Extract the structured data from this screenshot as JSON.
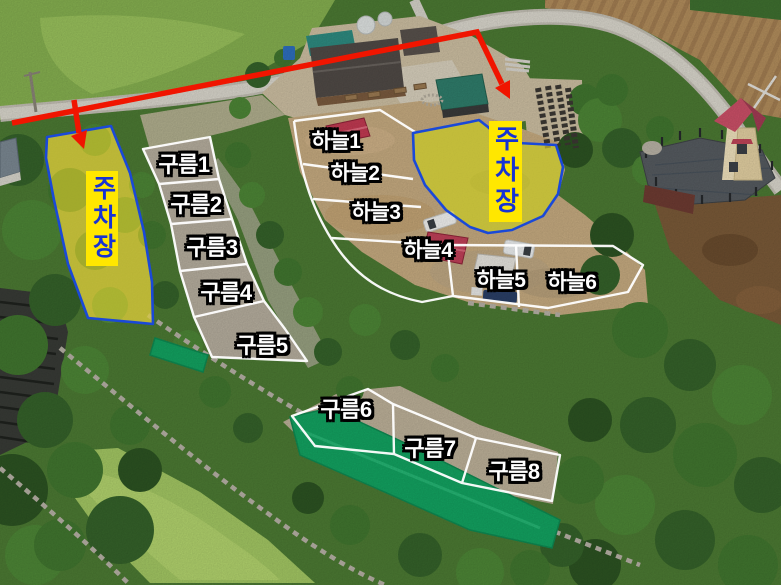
{
  "parking_left": {
    "label": "주차장"
  },
  "parking_right": {
    "label": "주차장"
  },
  "sites": {
    "sky": [
      {
        "label": "하늘1"
      },
      {
        "label": "하늘2"
      },
      {
        "label": "하늘3"
      },
      {
        "label": "하늘4"
      },
      {
        "label": "하늘5"
      },
      {
        "label": "하늘6"
      }
    ],
    "cloud": [
      {
        "label": "구름1"
      },
      {
        "label": "구름2"
      },
      {
        "label": "구름3"
      },
      {
        "label": "구름4"
      },
      {
        "label": "구름5"
      },
      {
        "label": "구름6"
      },
      {
        "label": "구름7"
      },
      {
        "label": "구름8"
      }
    ]
  },
  "colors": {
    "arrow": "#f01500",
    "parking_fill": "#e8d52e",
    "parking_border": "#1a49d8",
    "parking_text": "#1733d4",
    "parking_text_bg": "#ffe700",
    "site_text": "#ffffff",
    "site_text_outline": "#000000",
    "site_line": "#ffffff",
    "tarp": "#13a361"
  }
}
